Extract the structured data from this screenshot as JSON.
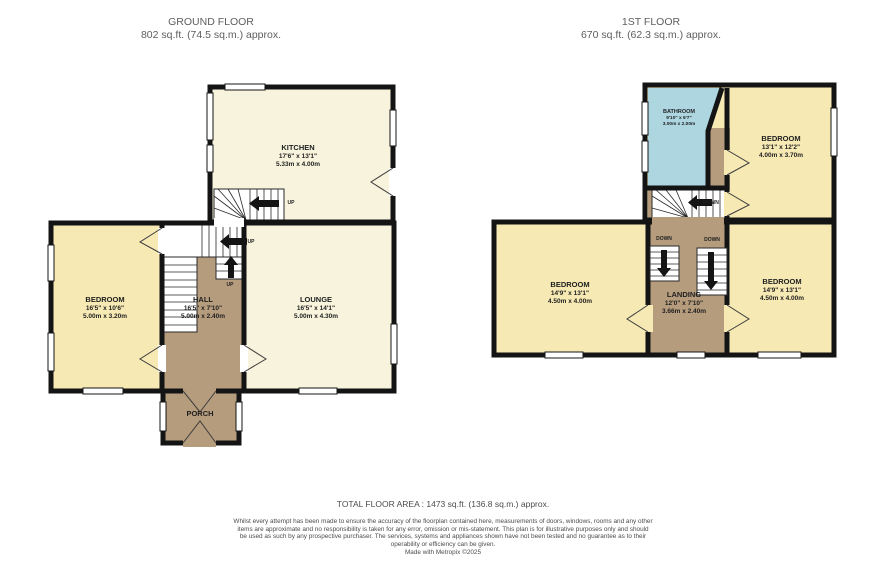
{
  "colors": {
    "wall": "#141414",
    "room_cream": "#f7f3dc",
    "room_yellow": "#f6e9b4",
    "room_tan": "#b59c7d",
    "room_blue": "#add6e1",
    "window": "#ffffff"
  },
  "ground_floor": {
    "title": "GROUND FLOOR",
    "area": "802 sq.ft. (74.5 sq.m.) approx.",
    "stairs_label": "UP",
    "rooms": {
      "kitchen": {
        "name": "KITCHEN",
        "imperial": "17'6\" x 13'1\"",
        "metric": "5.33m x 4.00m"
      },
      "bedroom": {
        "name": "BEDROOM",
        "imperial": "16'5\" x 10'6\"",
        "metric": "5.00m x 3.20m"
      },
      "hall": {
        "name": "HALL",
        "imperial": "16'5\" x 7'10\"",
        "metric": "5.00m x 2.40m"
      },
      "lounge": {
        "name": "LOUNGE",
        "imperial": "16'5\" x 14'1\"",
        "metric": "5.00m x 4.30m"
      },
      "porch": {
        "name": "PORCH"
      }
    }
  },
  "first_floor": {
    "title": "1ST FLOOR",
    "area": "670 sq.ft. (62.3 sq.m.) approx.",
    "stairs_label": "DOWN",
    "rooms": {
      "bathroom": {
        "name": "BATHROOM",
        "imperial": "9'10\" x 6'7\"",
        "metric": "3.00m x 2.00m"
      },
      "bedroom_top": {
        "name": "BEDROOM",
        "imperial": "13'1\" x 12'2\"",
        "metric": "4.00m x 3.70m"
      },
      "bedroom_left": {
        "name": "BEDROOM",
        "imperial": "14'9\" x 13'1\"",
        "metric": "4.50m x 4.00m"
      },
      "landing": {
        "name": "LANDING",
        "imperial": "12'0\" x 7'10\"",
        "metric": "3.66m x 2.40m"
      },
      "bedroom_right": {
        "name": "BEDROOM",
        "imperial": "14'9\" x 13'1\"",
        "metric": "4.50m x 4.00m"
      }
    }
  },
  "footer": {
    "total": "TOTAL FLOOR AREA : 1473 sq.ft. (136.8 sq.m.) approx.",
    "disclaimer": "Whilst every attempt has been made to ensure the accuracy of the floorplan contained here, measurements of doors, windows, rooms and any other items are approximate and no responsibility is taken for any error, omission or mis-statement. This plan is for illustrative purposes only and should be used as such by any prospective purchaser. The services, systems and appliances shown have not been tested and no guarantee as to their operability or efficiency can be given.",
    "credit": "Made with Metropix ©2025"
  }
}
